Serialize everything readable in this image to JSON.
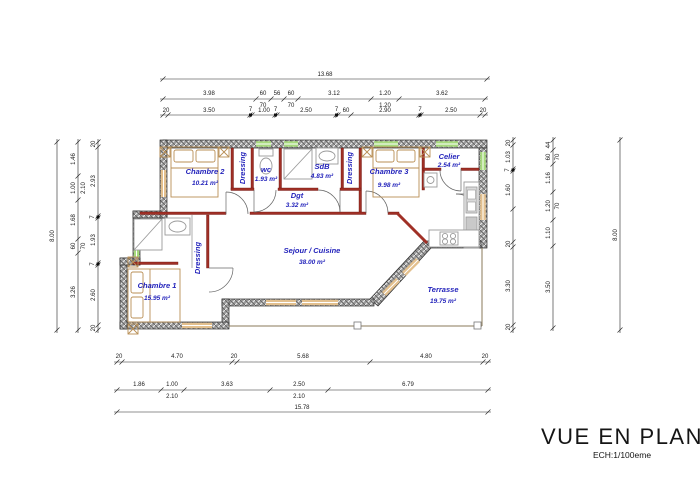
{
  "title": {
    "main": "VUE EN PLAN",
    "scale": "ECH:1/100eme"
  },
  "rooms": {
    "chambre2": {
      "name": "Chambre 2",
      "area": "10.21 m²"
    },
    "dressing1": {
      "name": "Dressing"
    },
    "wc": {
      "name": "wc",
      "area": "1.93 m²"
    },
    "sdb": {
      "name": "SdB",
      "area": "4.83 m²"
    },
    "dressing2": {
      "name": "Dressing"
    },
    "chambre3": {
      "name": "Chambre 3",
      "area": "9.98 m²"
    },
    "celier": {
      "name": "Celier",
      "area": "2.54 m²"
    },
    "dgt": {
      "name": "Dgt",
      "area": "3.32 m²"
    },
    "sejour": {
      "name": "Sejour / Cuisine",
      "area": "38.00 m²"
    },
    "dressing3": {
      "name": "Dressing"
    },
    "chambre1": {
      "name": "Chambre 1",
      "area": "15.95 m²"
    },
    "terrasse": {
      "name": "Terrasse",
      "area": "19.75 m²"
    }
  },
  "dimensions": {
    "top": {
      "total": "13.68",
      "row2": [
        "3.98",
        "60",
        "70",
        "56",
        "60",
        "70",
        "3.12",
        "1.20",
        "1.20",
        "3.62"
      ],
      "row3": [
        "20",
        "3.50",
        "7",
        "1.00",
        "7",
        "2.50",
        "7",
        "60",
        "2.90",
        "7",
        "2.50",
        "20"
      ]
    },
    "left": {
      "outer": "8.00",
      "mid": [
        "1.46",
        "1.00",
        "2.10",
        "1.68",
        "60",
        "70",
        "3.26"
      ],
      "inner": [
        "20",
        "2.93",
        "7",
        "1.93",
        "7",
        "2.60",
        "20"
      ]
    },
    "right": {
      "inner": [
        "20",
        "1.03",
        "7",
        "1.60",
        "20",
        "3.30",
        "20"
      ],
      "mid": [
        "44",
        "60",
        "70",
        "1.16",
        "1.20",
        "70",
        "1.10",
        "3.50"
      ],
      "outer": "8.00"
    },
    "bottom": {
      "row1": [
        "20",
        "4.70",
        "20",
        "5.68",
        "4.80",
        "20"
      ],
      "row2": [
        "1.86",
        "1.00",
        "2.10",
        "3.63",
        "2.50",
        "2.10",
        "6.79"
      ],
      "total": "15.78"
    }
  },
  "colors": {
    "wall_red": "#a03026",
    "label_blue": "#2323bb",
    "window_green": "#a6d97c",
    "window_wood": "#e3c08e",
    "wall_gray": "#8a8a8a"
  }
}
